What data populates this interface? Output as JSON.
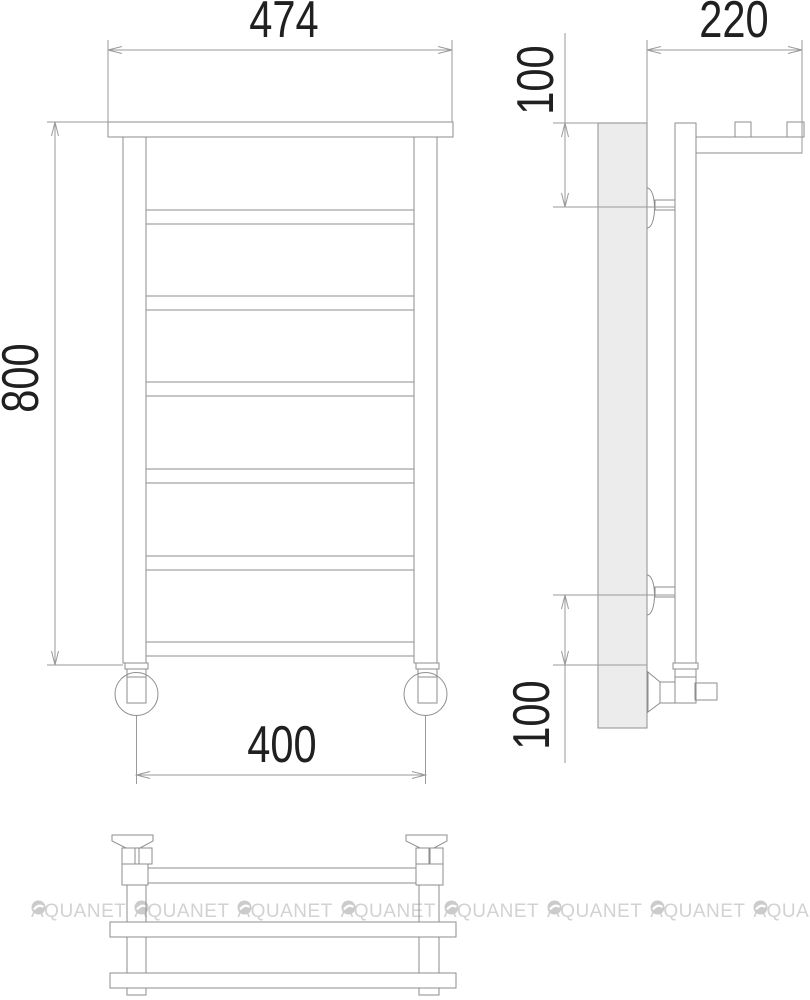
{
  "drawing": {
    "type": "heated-towel-rail-technical-drawing",
    "views": [
      "front",
      "side",
      "bottom"
    ],
    "dimension_labels": {
      "front_width": "474",
      "side_depth": "220",
      "front_height": "800",
      "pipe_spacing": "400",
      "top_bracket_offset": "100",
      "bottom_bracket_offset": "100"
    }
  },
  "watermark": {
    "text": "AQUANET",
    "repetitions": 8,
    "color": "#d2d2d2"
  },
  "colors": {
    "line": "#8e8e8e",
    "dimension_line": "#9a9a9a",
    "dimension_text": "#202020",
    "panel_fill": "#ececec",
    "background": "#ffffff"
  }
}
